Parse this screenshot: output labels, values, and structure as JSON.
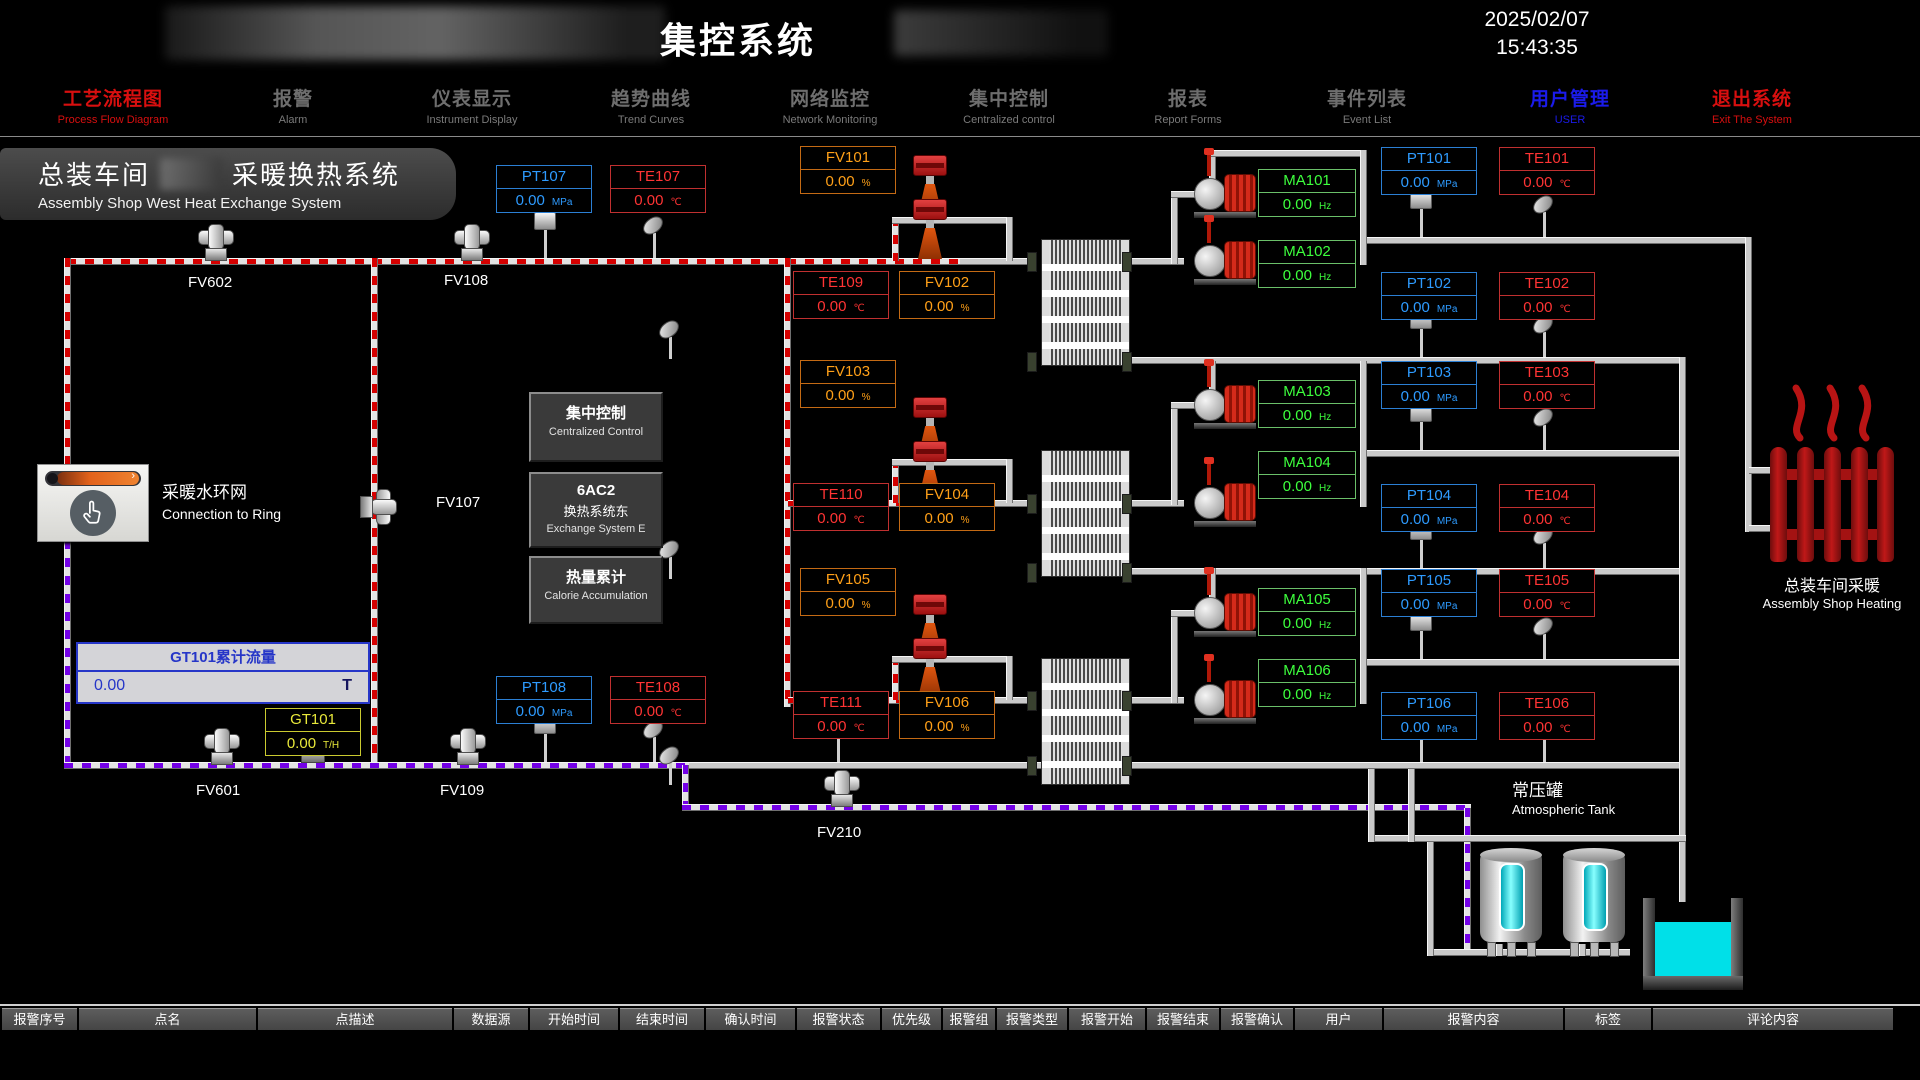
{
  "header": {
    "system_title": "集控系统",
    "date": "2025/02/07",
    "time": "15:43:35"
  },
  "nav": [
    {
      "zh": "工艺流程图",
      "en": "Process Flow Diagram"
    },
    {
      "zh": "报警",
      "en": "Alarm"
    },
    {
      "zh": "仪表显示",
      "en": "Instrument Display"
    },
    {
      "zh": "趋势曲线",
      "en": "Trend Curves"
    },
    {
      "zh": "网络监控",
      "en": "Network Monitoring"
    },
    {
      "zh": "集中控制",
      "en": "Centralized control"
    },
    {
      "zh": "报表",
      "en": "Report Forms"
    },
    {
      "zh": "事件列表",
      "en": "Event List"
    },
    {
      "zh": "用户管理",
      "en": "USER"
    },
    {
      "zh": "退出系统",
      "en": "Exit The System"
    }
  ],
  "title_block": {
    "zh_left": "总装车间",
    "zh_right": "采暖换热系统",
    "en": "Assembly Shop West Heat Exchange System"
  },
  "meters": {
    "PT101": {
      "label": "PT101",
      "value": "0.00",
      "unit": "MPa"
    },
    "PT102": {
      "label": "PT102",
      "value": "0.00",
      "unit": "MPa"
    },
    "PT103": {
      "label": "PT103",
      "value": "0.00",
      "unit": "MPa"
    },
    "PT104": {
      "label": "PT104",
      "value": "0.00",
      "unit": "MPa"
    },
    "PT105": {
      "label": "PT105",
      "value": "0.00",
      "unit": "MPa"
    },
    "PT106": {
      "label": "PT106",
      "value": "0.00",
      "unit": "MPa"
    },
    "PT107": {
      "label": "PT107",
      "value": "0.00",
      "unit": "MPa"
    },
    "PT108": {
      "label": "PT108",
      "value": "0.00",
      "unit": "MPa"
    },
    "TE101": {
      "label": "TE101",
      "value": "0.00",
      "unit": "℃"
    },
    "TE102": {
      "label": "TE102",
      "value": "0.00",
      "unit": "℃"
    },
    "TE103": {
      "label": "TE103",
      "value": "0.00",
      "unit": "℃"
    },
    "TE104": {
      "label": "TE104",
      "value": "0.00",
      "unit": "℃"
    },
    "TE105": {
      "label": "TE105",
      "value": "0.00",
      "unit": "℃"
    },
    "TE106": {
      "label": "TE106",
      "value": "0.00",
      "unit": "℃"
    },
    "TE107": {
      "label": "TE107",
      "value": "0.00",
      "unit": "℃"
    },
    "TE108": {
      "label": "TE108",
      "value": "0.00",
      "unit": "℃"
    },
    "TE109": {
      "label": "TE109",
      "value": "0.00",
      "unit": "℃"
    },
    "TE110": {
      "label": "TE110",
      "value": "0.00",
      "unit": "℃"
    },
    "TE111": {
      "label": "TE111",
      "value": "0.00",
      "unit": "℃"
    },
    "FV101": {
      "label": "FV101",
      "value": "0.00",
      "unit": "%"
    },
    "FV102": {
      "label": "FV102",
      "value": "0.00",
      "unit": "%"
    },
    "FV103": {
      "label": "FV103",
      "value": "0.00",
      "unit": "%"
    },
    "FV104": {
      "label": "FV104",
      "value": "0.00",
      "unit": "%"
    },
    "FV105": {
      "label": "FV105",
      "value": "0.00",
      "unit": "%"
    },
    "FV106": {
      "label": "FV106",
      "value": "0.00",
      "unit": "%"
    },
    "MA101": {
      "label": "MA101",
      "value": "0.00",
      "unit": "Hz"
    },
    "MA102": {
      "label": "MA102",
      "value": "0.00",
      "unit": "Hz"
    },
    "MA103": {
      "label": "MA103",
      "value": "0.00",
      "unit": "Hz"
    },
    "MA104": {
      "label": "MA104",
      "value": "0.00",
      "unit": "Hz"
    },
    "MA105": {
      "label": "MA105",
      "value": "0.00",
      "unit": "Hz"
    },
    "MA106": {
      "label": "MA106",
      "value": "0.00",
      "unit": "Hz"
    },
    "GT101": {
      "label": "GT101",
      "value": "0.00",
      "unit": "T/H"
    }
  },
  "accumulator": {
    "title": "GT101累计流量",
    "value": "0.00",
    "unit": "T"
  },
  "buttons": {
    "centralized": {
      "zh": "集中控制",
      "en": "Centralized Control"
    },
    "ac2": {
      "line1": "6AC2",
      "zh": "换热系统东",
      "en": "Exchange System E"
    },
    "calorie": {
      "zh": "热量累计",
      "en": "Calorie Accumulation"
    }
  },
  "ring_button": {
    "zh": "采暖水环网",
    "en": "Connection to Ring"
  },
  "valve_labels": {
    "fv602": "FV602",
    "fv108": "FV108",
    "fv107": "FV107",
    "fv601": "FV601",
    "fv109": "FV109",
    "fv210": "FV210"
  },
  "right_labels": {
    "radiator_zh": "总装车间采暖",
    "radiator_en": "Assembly Shop Heating",
    "tank_zh": "常压罐",
    "tank_en": "Atmospheric Tank"
  },
  "alarm_table": {
    "headers": [
      "报警序号",
      "点名",
      "点描述",
      "数据源",
      "开始时间",
      "结束时间",
      "确认时间",
      "报警状态",
      "优先级",
      "报警组",
      "报警类型",
      "报警开始",
      "报警结束",
      "报警确认",
      "用户",
      "报警内容",
      "标签",
      "评论内容"
    ]
  },
  "colors": {
    "supply": "#d40000",
    "return_line": "#7300e6",
    "pt": "#2e9bff",
    "te": "#ff3434",
    "fv": "#ffa018",
    "ma": "#3dff3d",
    "gt": "#e8e83a",
    "water": "#00e0e8",
    "radiator": "#b81414"
  }
}
